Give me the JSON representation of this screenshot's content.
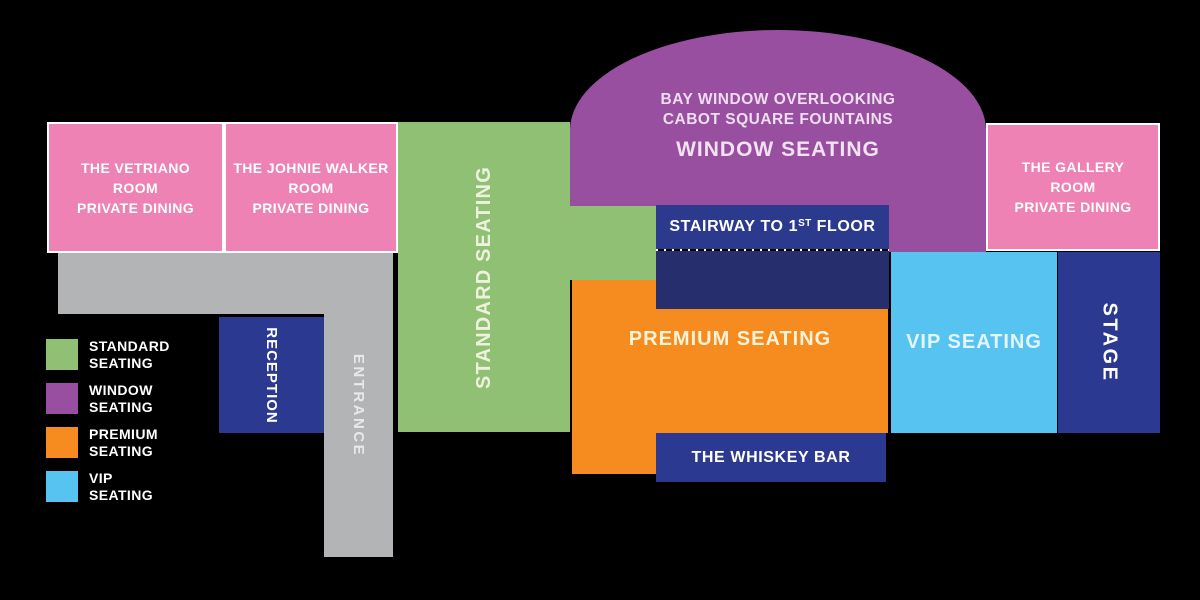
{
  "colors": {
    "background": "#000000",
    "pink": "#ee82b4",
    "green": "#8fc073",
    "purple": "#984f9f",
    "orange": "#f68b1f",
    "vip_blue": "#56c3f0",
    "navy": "#2b3a90",
    "stairway_navy": "#2c3a8e",
    "stairway_dark": "#262e6d",
    "gray": "#b2b4b6"
  },
  "rooms": {
    "vetriano": {
      "line1": "THE VETRIANO",
      "line2": "ROOM",
      "line3": "PRIVATE DINING"
    },
    "johnie": {
      "line1": "THE JOHNIE WALKER",
      "line2": "ROOM",
      "line3": "PRIVATE DINING"
    },
    "gallery": {
      "line1": "THE GALLERY",
      "line2": "ROOM",
      "line3": "PRIVATE DINING"
    }
  },
  "areas": {
    "standard_seating": "STANDARD SEATING",
    "window_seating": {
      "line1": "BAY WINDOW OVERLOOKING",
      "line2": "CABOT SQUARE FOUNTAINS",
      "title": "WINDOW SEATING"
    },
    "stairway": {
      "pre": "STAIRWAY TO 1",
      "sup": "ST",
      "post": " FLOOR"
    },
    "premium_seating": "PREMIUM SEATING",
    "vip_seating": "VIP SEATING",
    "whiskey_bar": "THE WHISKEY BAR",
    "stage": "STAGE",
    "reception": "RECEPTION",
    "entrance": "ENTRANCE"
  },
  "legend": {
    "items": [
      {
        "color": "#8fc073",
        "line1": "STANDARD",
        "line2": "SEATING"
      },
      {
        "color": "#984f9f",
        "line1": "WINDOW",
        "line2": "SEATING"
      },
      {
        "color": "#f68b1f",
        "line1": "PREMIUM",
        "line2": "SEATING"
      },
      {
        "color": "#56c3f0",
        "line1": "VIP",
        "line2": "SEATING"
      }
    ]
  }
}
